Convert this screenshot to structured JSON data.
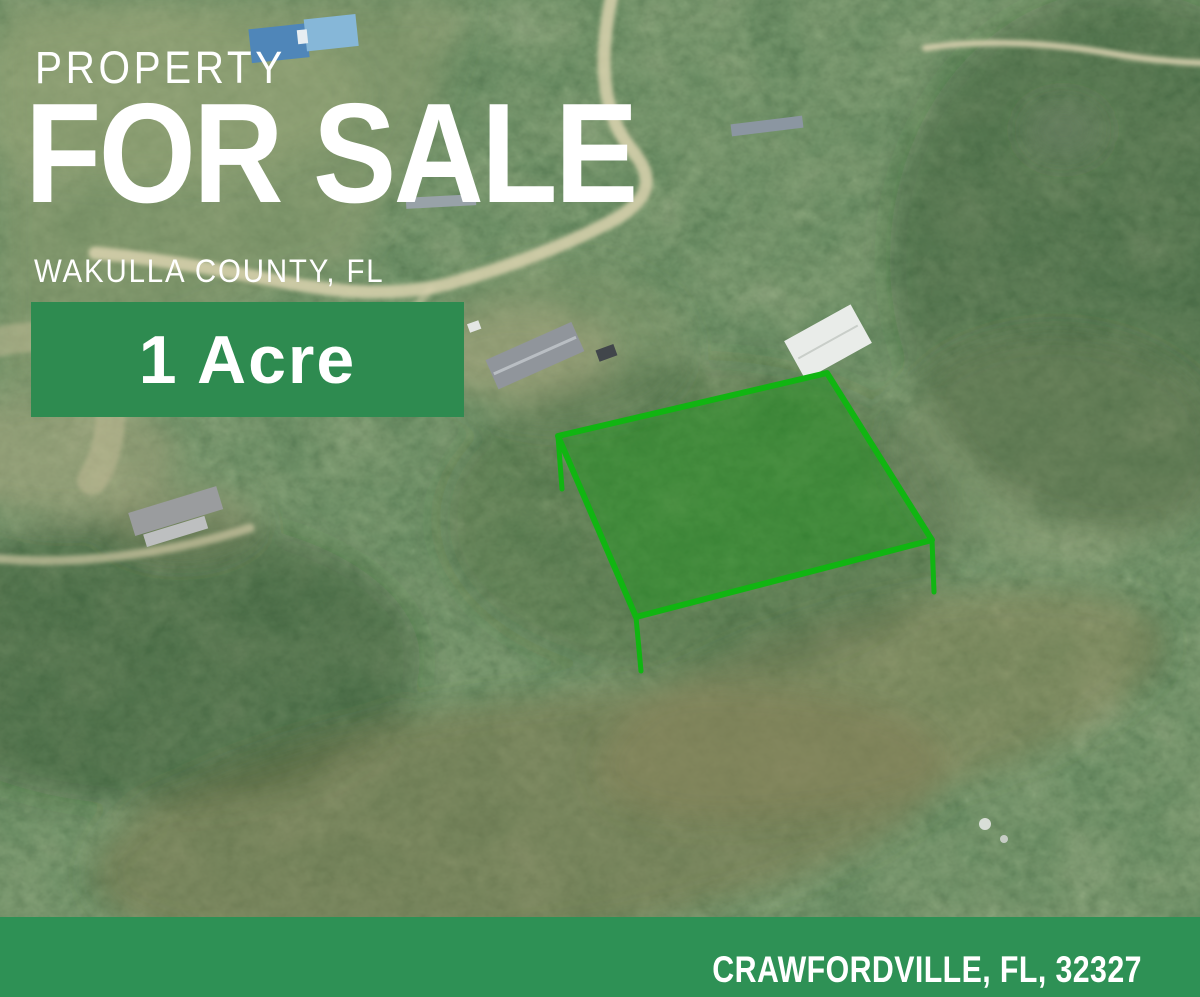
{
  "overlay": {
    "kicker": "PROPERTY",
    "title": "FOR SALE",
    "subtitle": "WAKULLA COUNTY, FL",
    "badge_label": "1 Acre",
    "footer_location": "CRAWFORDVILLE, FL, 32327"
  },
  "colors": {
    "badge_green": "#2E8B50",
    "banner_green": "#2E9155",
    "boundary_stroke": "#11B512",
    "boundary_fill": "rgba(28,150,28,0.45)",
    "text_white": "#FFFFFF"
  },
  "map": {
    "type": "satellite-aerial",
    "boundary": {
      "points": [
        [
          558,
          436
        ],
        [
          827,
          373
        ],
        [
          932,
          540
        ],
        [
          636,
          617
        ]
      ],
      "legs": [
        [
          [
            558,
            436
          ],
          [
            562,
            489
          ]
        ],
        [
          [
            636,
            617
          ],
          [
            641,
            671
          ]
        ],
        [
          [
            932,
            540
          ],
          [
            934,
            592
          ]
        ]
      ]
    }
  }
}
